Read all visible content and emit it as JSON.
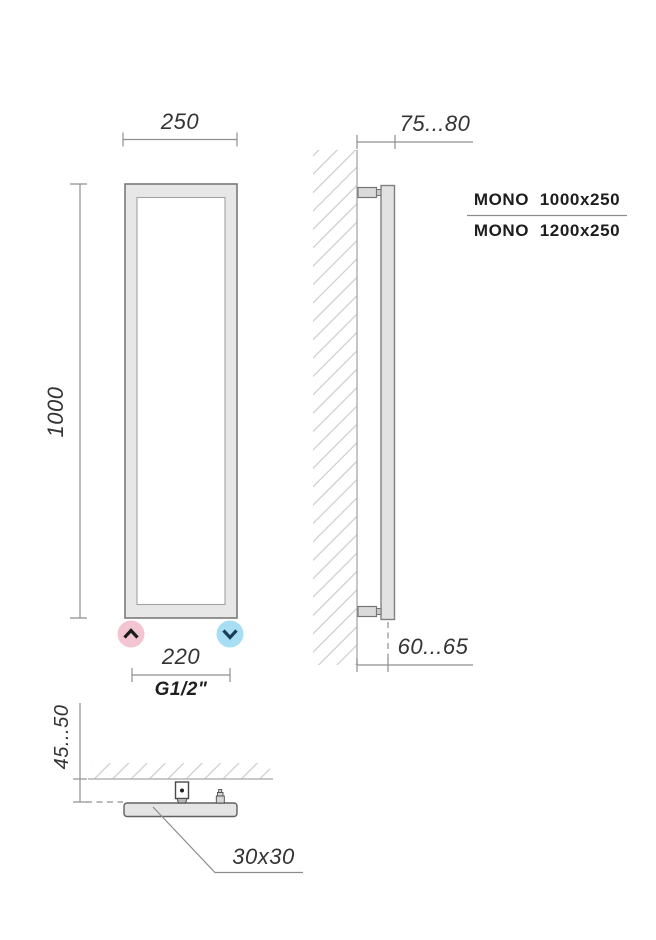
{
  "front_view": {
    "width_dim": "250",
    "height_dim": "1000",
    "pipe_spacing_dim": "220",
    "thread_label": "G1/2\""
  },
  "side_view": {
    "wall_offset_top_dim": "75...80",
    "wall_offset_axis_dim": "60...65"
  },
  "models": {
    "first": "MONO  1000x250",
    "second": "MONO  1200x250"
  },
  "section_view": {
    "wall_clearance_dim": "45...50",
    "profile_size_label": "30x30"
  },
  "icons": {
    "inlet": "chevron-up-icon",
    "outlet": "chevron-down-icon"
  },
  "colors": {
    "inlet_pink": "#f3c4d2",
    "outlet_blue": "#a7def3",
    "chevron_dark": "#1b1b1b",
    "chevron_navy": "#1c3b57",
    "profile_fill": "#e6e6e6",
    "profile_stroke": "#7a7a7a",
    "dimension_line": "#8f8f8f",
    "hatch": "#cfcfcf",
    "text": "#333333"
  }
}
